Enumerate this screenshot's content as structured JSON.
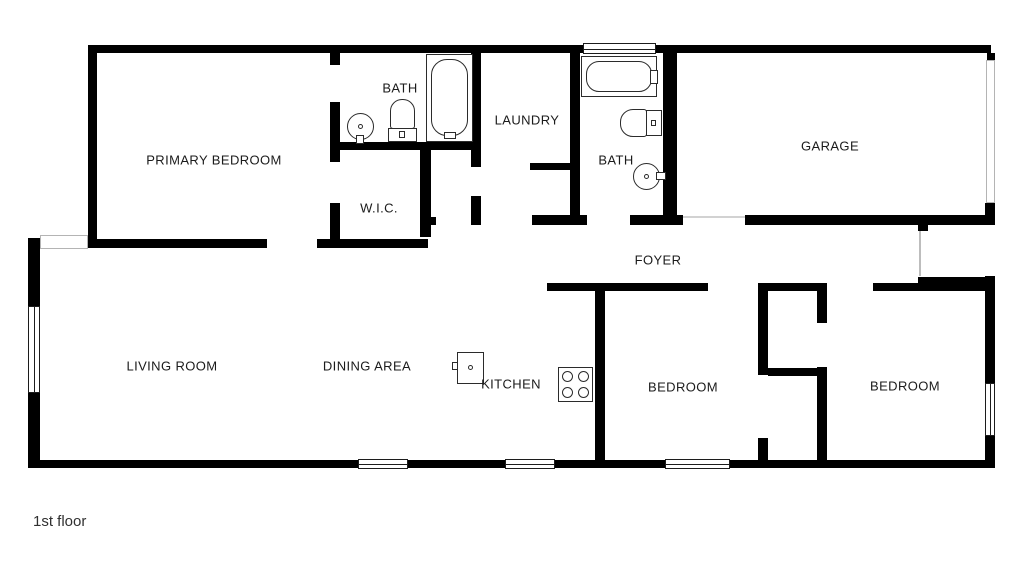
{
  "page": {
    "title_label": "1st floor",
    "background": "#ffffff",
    "wall_color": "#000000"
  },
  "floorplan": {
    "canvas": {
      "w": 1024,
      "h": 576
    },
    "rooms": [
      {
        "id": "primary-bedroom",
        "label": "PRIMARY BEDROOM",
        "cx": 214,
        "cy": 160
      },
      {
        "id": "bath-1",
        "label": "BATH",
        "cx": 400,
        "cy": 88
      },
      {
        "id": "wic",
        "label": "W.I.C.",
        "cx": 379,
        "cy": 208
      },
      {
        "id": "laundry",
        "label": "LAUNDRY",
        "cx": 527,
        "cy": 120
      },
      {
        "id": "bath-2",
        "label": "BATH",
        "cx": 616,
        "cy": 160
      },
      {
        "id": "garage",
        "label": "GARAGE",
        "cx": 830,
        "cy": 146
      },
      {
        "id": "foyer",
        "label": "FOYER",
        "cx": 658,
        "cy": 260
      },
      {
        "id": "living-room",
        "label": "LIVING ROOM",
        "cx": 172,
        "cy": 366
      },
      {
        "id": "dining-area",
        "label": "DINING AREA",
        "cx": 367,
        "cy": 366
      },
      {
        "id": "kitchen",
        "label": "KITCHEN",
        "cx": 511,
        "cy": 384
      },
      {
        "id": "bedroom-1",
        "label": "BEDROOM",
        "cx": 683,
        "cy": 387
      },
      {
        "id": "bedroom-2",
        "label": "BEDROOM",
        "cx": 905,
        "cy": 386
      }
    ],
    "walls": [
      {
        "x": 88,
        "y": 45,
        "w": 495,
        "h": 8
      },
      {
        "x": 656,
        "y": 45,
        "w": 335,
        "h": 8
      },
      {
        "x": 88,
        "y": 53,
        "w": 9,
        "h": 195
      },
      {
        "x": 88,
        "y": 239,
        "w": 179,
        "h": 9
      },
      {
        "x": 317,
        "y": 239,
        "w": 111,
        "h": 9
      },
      {
        "x": 28,
        "y": 238,
        "w": 12,
        "h": 68
      },
      {
        "x": 28,
        "y": 393,
        "w": 12,
        "h": 75
      },
      {
        "x": 28,
        "y": 460,
        "w": 330,
        "h": 8
      },
      {
        "x": 408,
        "y": 460,
        "w": 97,
        "h": 8
      },
      {
        "x": 555,
        "y": 460,
        "w": 110,
        "h": 8
      },
      {
        "x": 730,
        "y": 460,
        "w": 265,
        "h": 8
      },
      {
        "x": 987,
        "y": 53,
        "w": 8,
        "h": 9
      },
      {
        "x": 985,
        "y": 203,
        "w": 10,
        "h": 22
      },
      {
        "x": 985,
        "y": 276,
        "w": 10,
        "h": 107
      },
      {
        "x": 985,
        "y": 436,
        "w": 10,
        "h": 26
      },
      {
        "x": 330,
        "y": 53,
        "w": 10,
        "h": 12
      },
      {
        "x": 330,
        "y": 102,
        "w": 10,
        "h": 60
      },
      {
        "x": 330,
        "y": 203,
        "w": 10,
        "h": 45
      },
      {
        "x": 330,
        "y": 142,
        "w": 151,
        "h": 8
      },
      {
        "x": 471,
        "y": 53,
        "w": 10,
        "h": 97
      },
      {
        "x": 471,
        "y": 150,
        "w": 10,
        "h": 17
      },
      {
        "x": 471,
        "y": 196,
        "w": 10,
        "h": 29
      },
      {
        "x": 420,
        "y": 150,
        "w": 11,
        "h": 87
      },
      {
        "x": 430,
        "y": 217,
        "w": 6,
        "h": 8
      },
      {
        "x": 530,
        "y": 163,
        "w": 40,
        "h": 7
      },
      {
        "x": 570,
        "y": 45,
        "w": 10,
        "h": 170
      },
      {
        "x": 532,
        "y": 215,
        "w": 55,
        "h": 10
      },
      {
        "x": 630,
        "y": 215,
        "w": 53,
        "h": 10
      },
      {
        "x": 663,
        "y": 48,
        "w": 14,
        "h": 168
      },
      {
        "x": 745,
        "y": 215,
        "w": 250,
        "h": 10
      },
      {
        "x": 918,
        "y": 225,
        "w": 10,
        "h": 6
      },
      {
        "x": 547,
        "y": 283,
        "w": 161,
        "h": 8
      },
      {
        "x": 758,
        "y": 283,
        "w": 69,
        "h": 8
      },
      {
        "x": 873,
        "y": 283,
        "w": 45,
        "h": 8
      },
      {
        "x": 918,
        "y": 277,
        "w": 77,
        "h": 14
      },
      {
        "x": 595,
        "y": 291,
        "w": 10,
        "h": 169
      },
      {
        "x": 758,
        "y": 291,
        "w": 10,
        "h": 84
      },
      {
        "x": 758,
        "y": 438,
        "w": 10,
        "h": 22
      },
      {
        "x": 768,
        "y": 368,
        "w": 49,
        "h": 8
      },
      {
        "x": 817,
        "y": 291,
        "w": 10,
        "h": 32
      },
      {
        "x": 817,
        "y": 367,
        "w": 10,
        "h": 93
      }
    ],
    "windows": [
      {
        "name": "window-bath2-top",
        "x": 583,
        "y": 43,
        "w": 73,
        "h": 11,
        "style": "dark"
      },
      {
        "name": "window-living-left",
        "x": 28,
        "y": 306,
        "w": 12,
        "h": 87,
        "style": "dark"
      },
      {
        "name": "window-living-bottom",
        "x": 358,
        "y": 459,
        "w": 50,
        "h": 10,
        "style": "dark"
      },
      {
        "name": "window-dining-bottom",
        "x": 505,
        "y": 459,
        "w": 50,
        "h": 10,
        "style": "dark"
      },
      {
        "name": "window-bedroom1-bottom",
        "x": 665,
        "y": 459,
        "w": 65,
        "h": 10,
        "style": "dark"
      },
      {
        "name": "window-bedroom2-right",
        "x": 985,
        "y": 383,
        "w": 10,
        "h": 53,
        "style": "dark"
      },
      {
        "name": "window-living-corner",
        "x": 40,
        "y": 235,
        "w": 48,
        "h": 14,
        "style": "light"
      },
      {
        "name": "garage-door-opening",
        "x": 986,
        "y": 60,
        "w": 9,
        "h": 143,
        "style": "light"
      }
    ],
    "lines": [
      {
        "name": "porch-line",
        "x": 919,
        "y": 231,
        "w": 2,
        "h": 45,
        "color": "#bdbdbd"
      },
      {
        "name": "threshold-line",
        "x": 683,
        "y": 216,
        "w": 62,
        "h": 2,
        "color": "#d2d2d2"
      }
    ],
    "fixtures": [
      {
        "name": "bathtub-1-outer",
        "shape": "rect",
        "x": 426,
        "y": 54,
        "w": 47,
        "h": 88
      },
      {
        "name": "bathtub-1-basin",
        "shape": "round",
        "x": 431,
        "y": 59,
        "w": 37,
        "h": 77,
        "radius": "16px"
      },
      {
        "name": "bathtub-1-faucet",
        "shape": "rect",
        "x": 444,
        "y": 132,
        "w": 12,
        "h": 7,
        "thin": true
      },
      {
        "name": "toilet-1-bowl",
        "shape": "round",
        "x": 390,
        "y": 99,
        "w": 25,
        "h": 30,
        "radius": "12px 12px 3px 3px"
      },
      {
        "name": "toilet-1-tank",
        "shape": "rect",
        "x": 388,
        "y": 128,
        "w": 29,
        "h": 14
      },
      {
        "name": "toilet-1-button",
        "shape": "rect",
        "x": 399,
        "y": 131,
        "w": 6,
        "h": 7,
        "thin": true
      },
      {
        "name": "sink-1-basin",
        "shape": "circle",
        "x": 347,
        "y": 113,
        "w": 27,
        "h": 27
      },
      {
        "name": "sink-1-faucet",
        "shape": "rect",
        "x": 356,
        "y": 135,
        "w": 8,
        "h": 9,
        "thin": true
      },
      {
        "name": "sink-1-drain",
        "shape": "circle",
        "x": 358,
        "y": 124,
        "w": 5,
        "h": 5,
        "thin": true
      },
      {
        "name": "bathtub-2-outer",
        "shape": "rect",
        "x": 581,
        "y": 56,
        "w": 76,
        "h": 41
      },
      {
        "name": "bathtub-2-basin",
        "shape": "round",
        "x": 586,
        "y": 61,
        "w": 66,
        "h": 31,
        "radius": "13px"
      },
      {
        "name": "bathtub-2-faucet",
        "shape": "rect",
        "x": 650,
        "y": 70,
        "w": 8,
        "h": 14,
        "thin": true
      },
      {
        "name": "toilet-2-bowl",
        "shape": "round",
        "x": 620,
        "y": 109,
        "w": 27,
        "h": 28,
        "radius": "13px 3px 3px 13px"
      },
      {
        "name": "toilet-2-tank",
        "shape": "rect",
        "x": 646,
        "y": 110,
        "w": 16,
        "h": 26
      },
      {
        "name": "toilet-2-button",
        "shape": "rect",
        "x": 651,
        "y": 120,
        "w": 5,
        "h": 6,
        "thin": true
      },
      {
        "name": "sink-2-basin",
        "shape": "circle",
        "x": 633,
        "y": 163,
        "w": 27,
        "h": 27
      },
      {
        "name": "sink-2-faucet",
        "shape": "rect",
        "x": 656,
        "y": 172,
        "w": 10,
        "h": 8,
        "thin": true
      },
      {
        "name": "sink-2-drain",
        "shape": "circle",
        "x": 644,
        "y": 174,
        "w": 5,
        "h": 5,
        "thin": true
      },
      {
        "name": "stove-body",
        "shape": "rect",
        "x": 558,
        "y": 367,
        "w": 35,
        "h": 35
      },
      {
        "name": "stove-burner-1",
        "shape": "circle",
        "x": 562,
        "y": 371,
        "w": 11,
        "h": 11,
        "thin": true
      },
      {
        "name": "stove-burner-2",
        "shape": "circle",
        "x": 578,
        "y": 371,
        "w": 11,
        "h": 11,
        "thin": true
      },
      {
        "name": "stove-burner-3",
        "shape": "circle",
        "x": 562,
        "y": 387,
        "w": 11,
        "h": 11,
        "thin": true
      },
      {
        "name": "stove-burner-4",
        "shape": "circle",
        "x": 578,
        "y": 387,
        "w": 11,
        "h": 11,
        "thin": true
      },
      {
        "name": "kitchen-appliance-body",
        "shape": "rect",
        "x": 457,
        "y": 352,
        "w": 27,
        "h": 32
      },
      {
        "name": "kitchen-appliance-knob",
        "shape": "circle",
        "x": 468,
        "y": 365,
        "w": 5,
        "h": 5,
        "thin": true
      },
      {
        "name": "kitchen-appliance-tab",
        "shape": "rect",
        "x": 452,
        "y": 362,
        "w": 6,
        "h": 8,
        "thin": true
      }
    ]
  }
}
